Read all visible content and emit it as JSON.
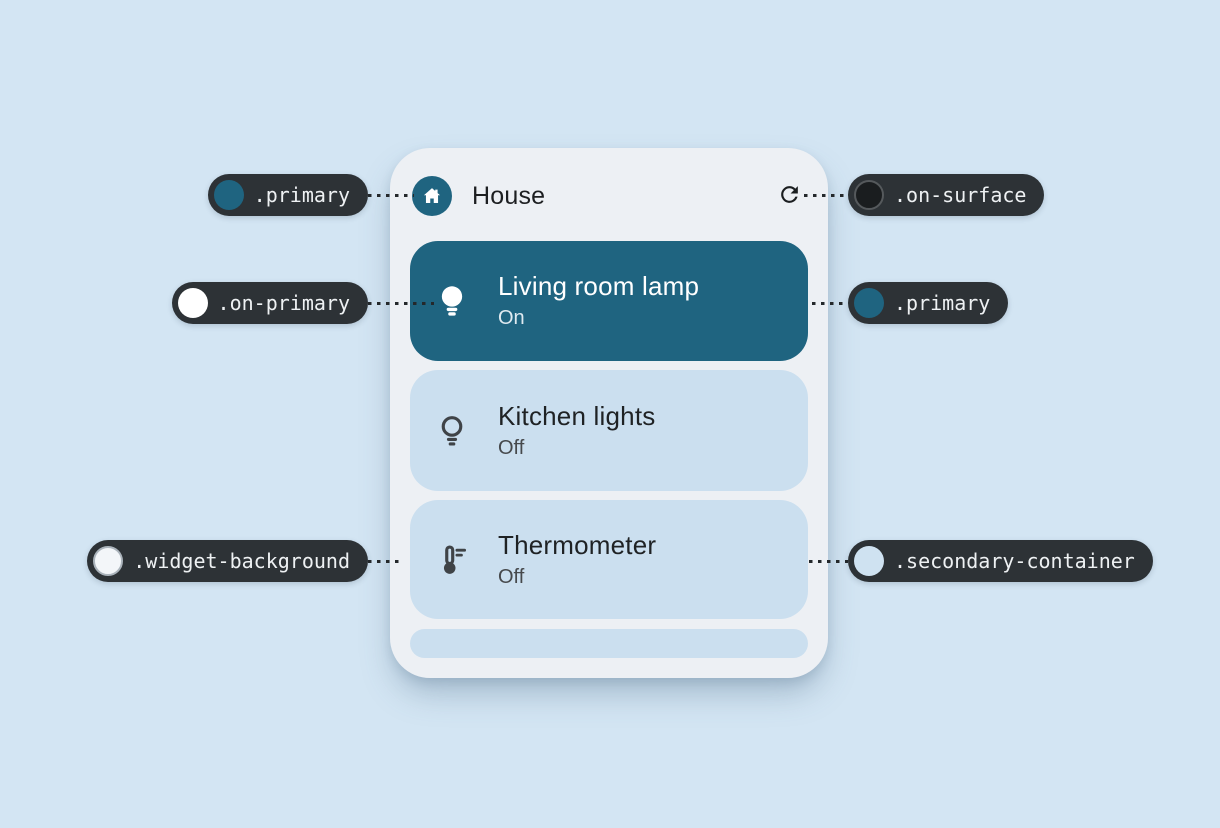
{
  "widget": {
    "title": "House",
    "devices": [
      {
        "name": "Living room lamp",
        "status": "On",
        "icon": "lightbulb-on-icon",
        "active": true
      },
      {
        "name": "Kitchen lights",
        "status": "Off",
        "icon": "lightbulb-off-icon",
        "active": false
      },
      {
        "name": "Thermometer",
        "status": "Off",
        "icon": "thermostat-icon",
        "active": false
      }
    ]
  },
  "annotations": [
    {
      "label": ".primary",
      "swatch": "#1f6480",
      "points_to": "header-app-icon"
    },
    {
      "label": ".on-surface",
      "swatch": "#1a1d1f",
      "points_to": "refresh-icon"
    },
    {
      "label": ".on-primary",
      "swatch": "#ffffff",
      "points_to": "active-row-icon-and-text"
    },
    {
      "label": ".primary",
      "swatch": "#1f6480",
      "points_to": "active-row-background"
    },
    {
      "label": ".widget-background",
      "swatch": "#f3f6f9",
      "points_to": "widget-card-background"
    },
    {
      "label": ".secondary-container",
      "swatch": "#cfe2f1",
      "points_to": "inactive-row-background"
    }
  ],
  "colors": {
    "page_background": "#d3e5f3",
    "widget_background": "#edf0f4",
    "primary": "#1f6480",
    "on_primary": "#ffffff",
    "secondary_container": "#cbdfef",
    "on_surface": "#1f2224",
    "status_text": "#46494c",
    "callout_background": "#2d3236",
    "callout_text": "#eef1f3"
  }
}
